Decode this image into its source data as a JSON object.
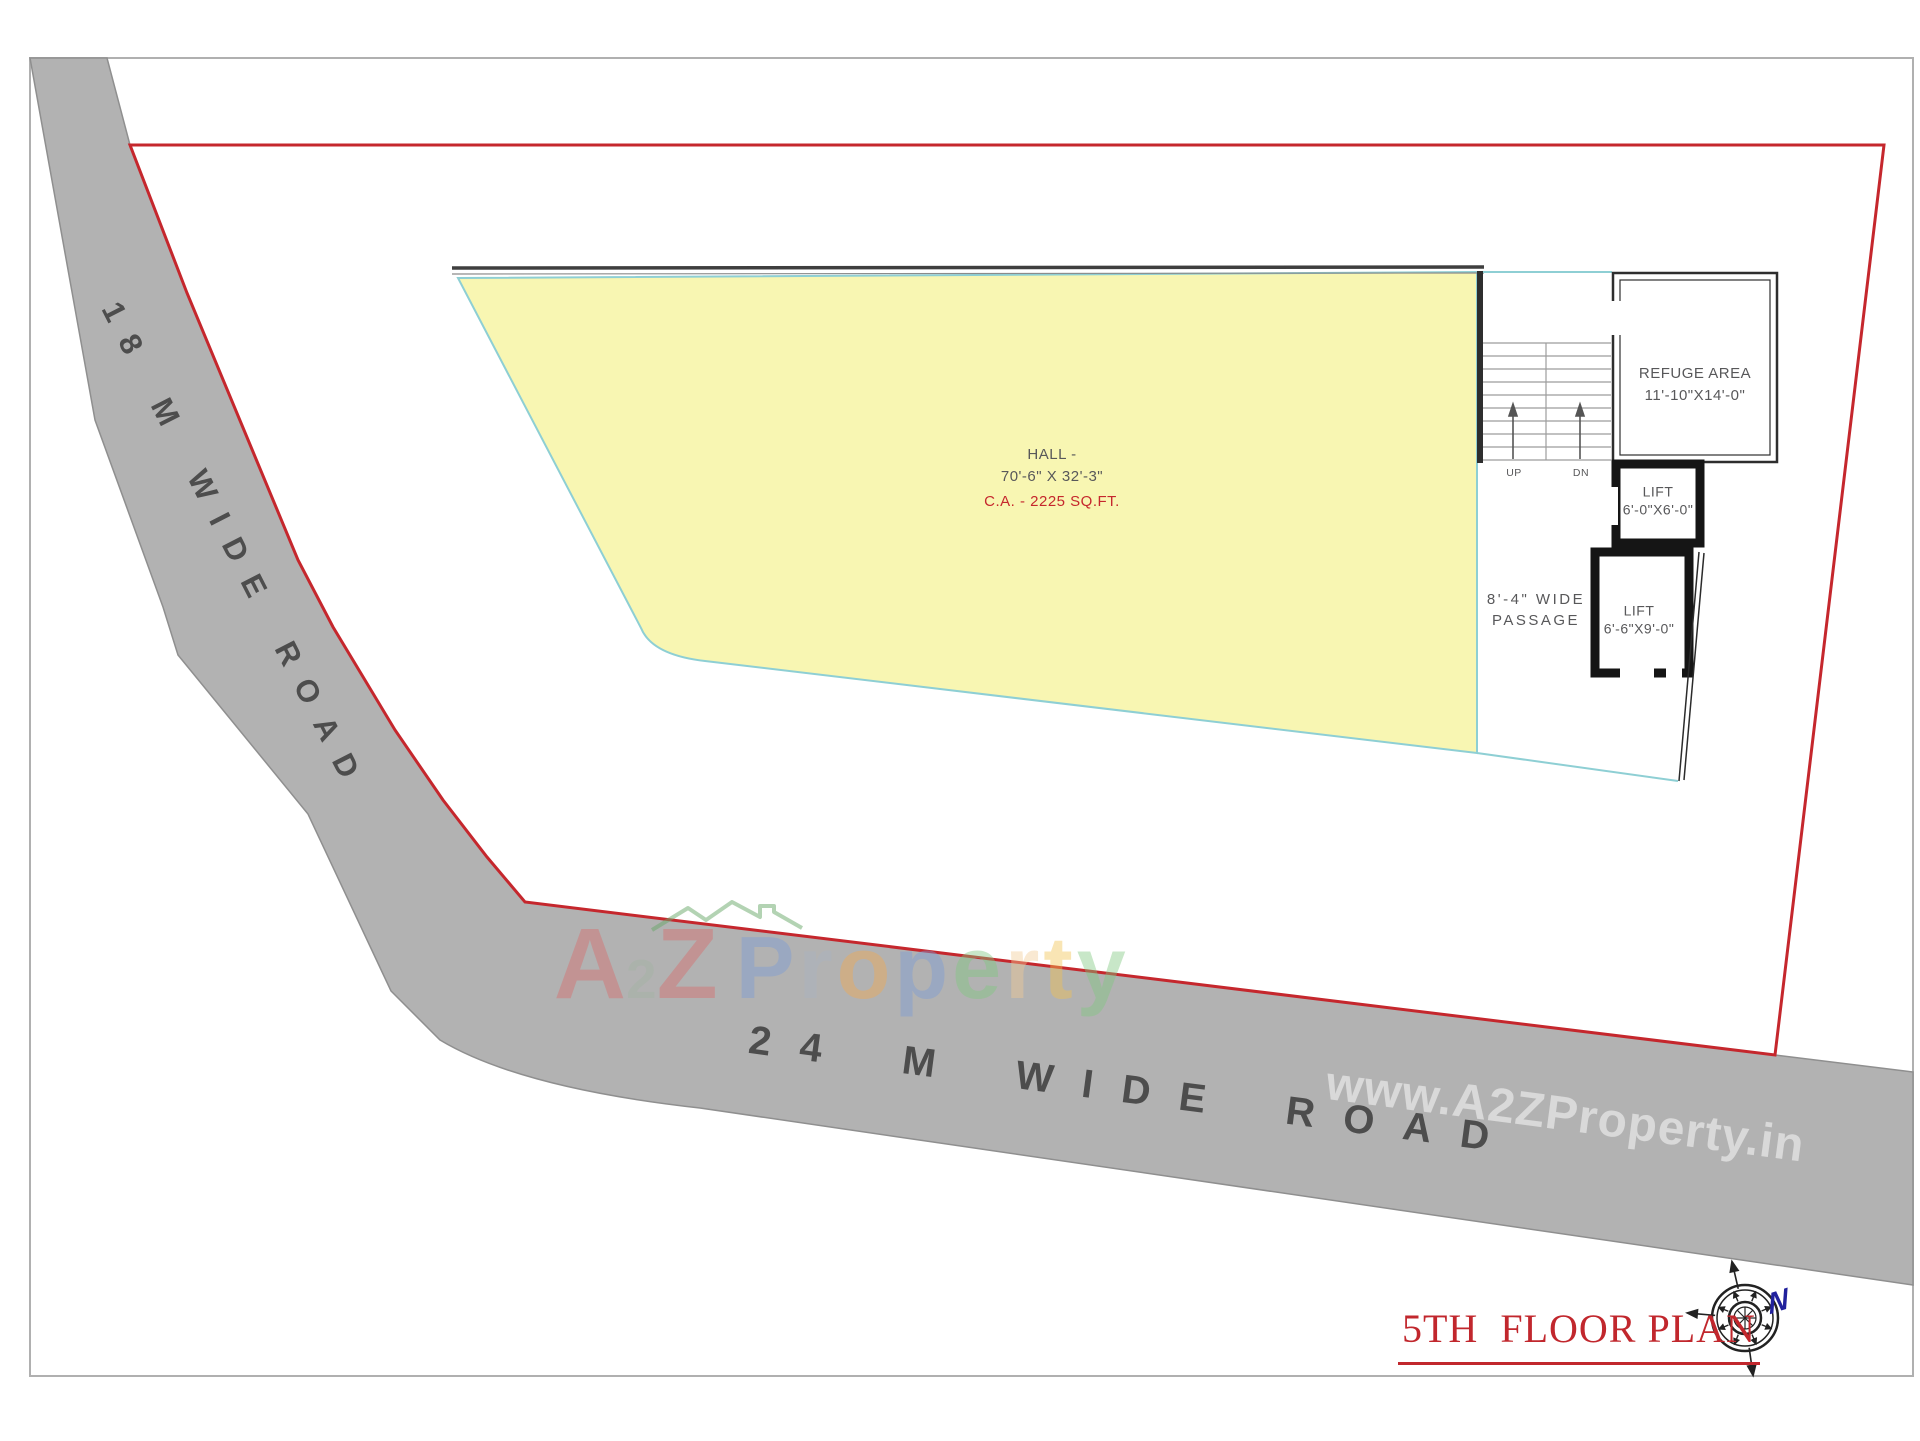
{
  "page": {
    "title": "5TH  FLOOR PLAN"
  },
  "roads": {
    "left_label": "18 M WIDE ROAD",
    "bottom_label": "24 M WIDE ROAD"
  },
  "hall": {
    "name": "HALL -",
    "dimensions": "70'-6\" X 32'-3\"",
    "area": "C.A. - 2225 SQ.FT."
  },
  "refuge": {
    "name": "REFUGE AREA",
    "dimensions": "11'-10\"X14'-0\""
  },
  "lift_small": {
    "name": "LIFT",
    "dimensions": "6'-0\"X6'-0\""
  },
  "lift_large": {
    "name": "LIFT",
    "dimensions": "6'-6\"X9'-0\""
  },
  "passage": {
    "line1": "8'-4\" WIDE",
    "line2": "PASSAGE"
  },
  "stairs": {
    "up_label": "UP",
    "down_label": "DN"
  },
  "compass": {
    "north_label": "N"
  },
  "watermark": {
    "logo_letters": [
      {
        "ch": "A",
        "color": "#d96a6a"
      },
      {
        "ch": "2",
        "color": "#a3b3a3",
        "small": true
      },
      {
        "ch": "Z",
        "color": "#d96a6a"
      }
    ],
    "word_letters": [
      {
        "ch": "P",
        "color": "#7b9bd6"
      },
      {
        "ch": "r",
        "color": "#aab3c2"
      },
      {
        "ch": "o",
        "color": "#f2a94f"
      },
      {
        "ch": "p",
        "color": "#7b9bd6"
      },
      {
        "ch": "e",
        "color": "#7ec87e"
      },
      {
        "ch": "r",
        "color": "#f3cc95"
      },
      {
        "ch": "t",
        "color": "#f2c24f"
      },
      {
        "ch": "y",
        "color": "#7ec87e"
      }
    ],
    "url": "www.A2ZProperty.in"
  },
  "colors": {
    "road_fill": "#b2b2b2",
    "road_text": "#4d4d4d",
    "boundary_red": "#c5272d",
    "hall_fill": "#f8f6b2",
    "hall_stroke": "#8ecfd4",
    "wall_dark": "#151515",
    "text_gray": "#58585a",
    "title_red": "#c1272d",
    "north_blue": "#21219c",
    "frame_gray": "#b0b0b0",
    "stair_line": "#9c9c9c"
  }
}
